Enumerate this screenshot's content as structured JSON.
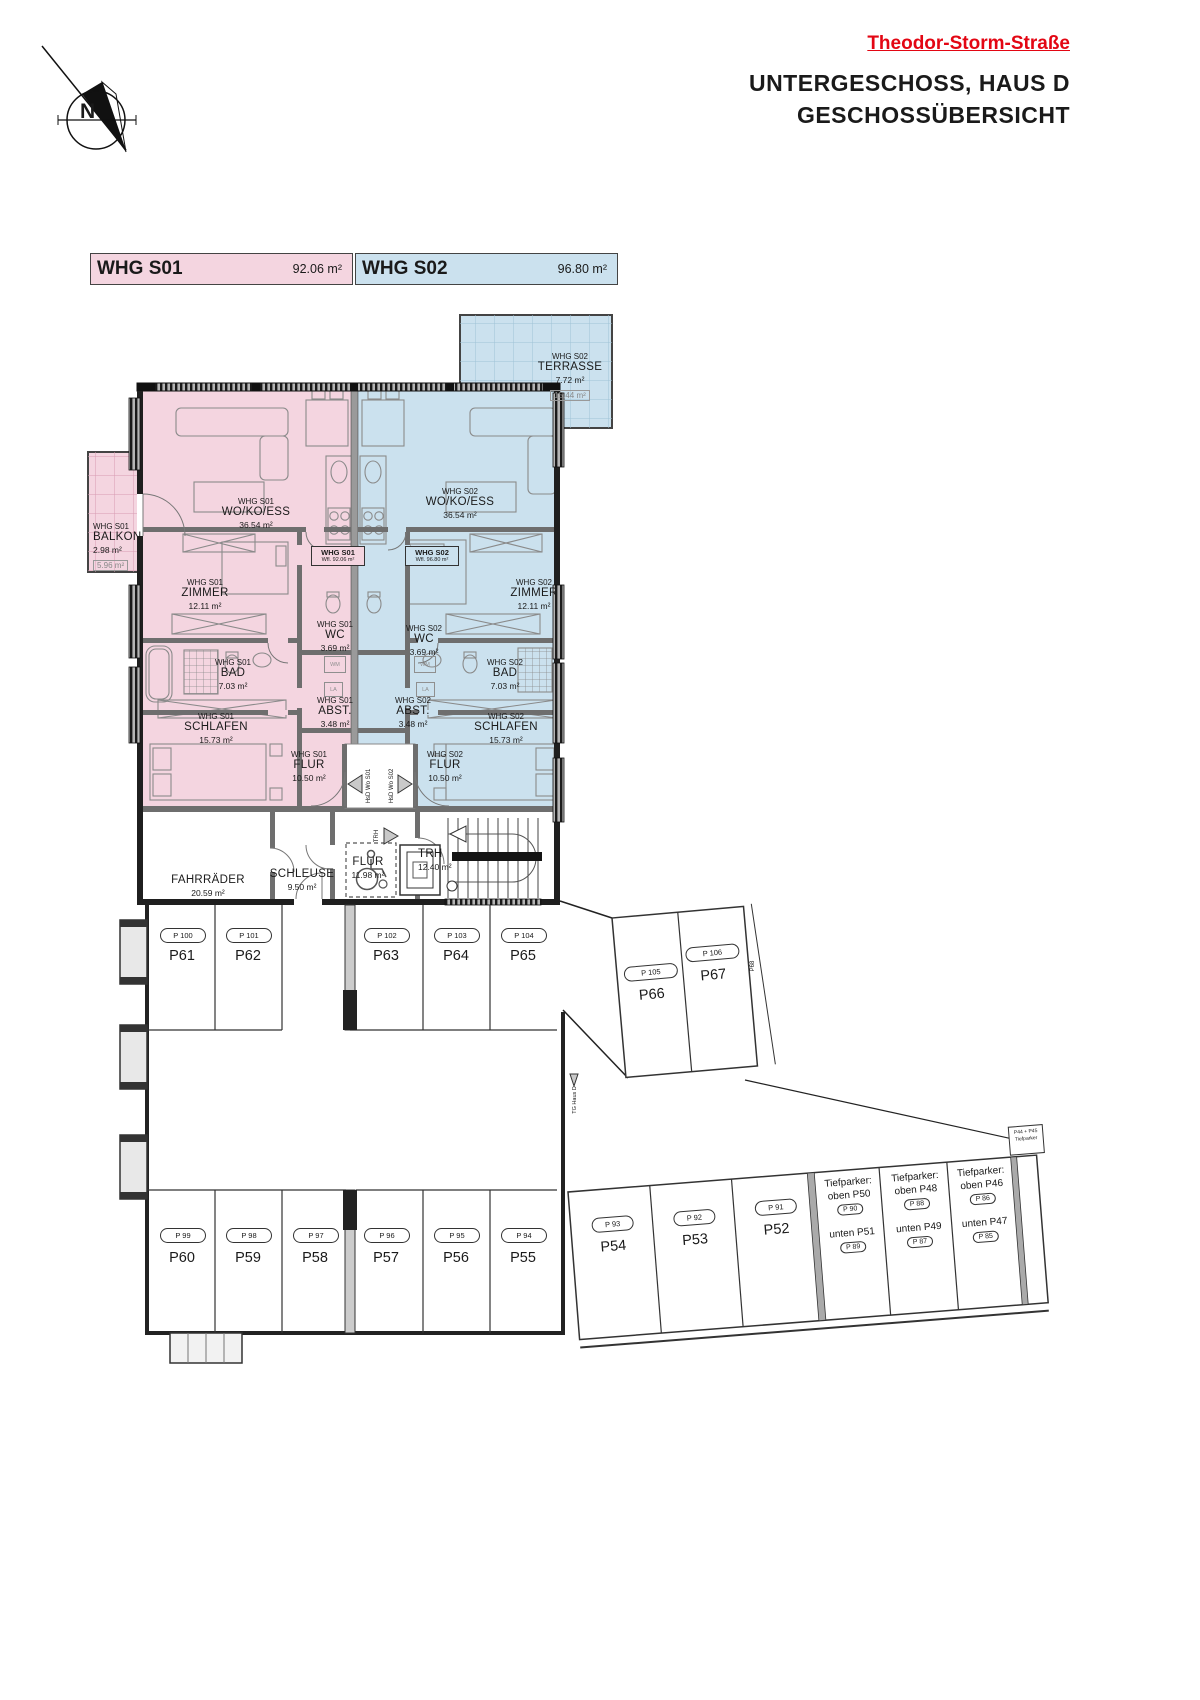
{
  "header": {
    "street": "Theodor-Storm-Straße",
    "line1": "UNTERGESCHOSS, HAUS D",
    "line2": "GESCHOSSÜBERSICHT"
  },
  "compass": {
    "n": "N"
  },
  "colors": {
    "s01": "#f4d5e0",
    "s02": "#cbe1ee",
    "accent_red": "#e30613"
  },
  "legend": {
    "s01": {
      "name": "WHG S01",
      "area": "92.06 m²"
    },
    "s02": {
      "name": "WHG S02",
      "area": "96.80 m²"
    }
  },
  "wfl": {
    "s01": {
      "line1": "WHG S01",
      "line2": "Wfl. 92.06 m²"
    },
    "s02": {
      "line1": "WHG S02",
      "line2": "Wfl. 96.80 m²"
    }
  },
  "outdoor": {
    "terrasse": {
      "whg": "WHG S02",
      "name": "TERRASSE",
      "area": "7.72 m²",
      "half": "15.44 m²"
    },
    "balkon": {
      "whg": "WHG S01",
      "name": "BALKON",
      "area": "2.98 m²",
      "half": "5.96 m²"
    }
  },
  "apartments": {
    "s01": {
      "rooms": {
        "wo": {
          "whg": "WHG S01",
          "name": "WO/KO/ESS",
          "area": "36.54 m²"
        },
        "zimmer": {
          "whg": "WHG S01",
          "name": "ZIMMER",
          "area": "12.11 m²"
        },
        "wc": {
          "whg": "WHG S01",
          "name": "WC",
          "area": "3.69 m²"
        },
        "bad": {
          "whg": "WHG S01",
          "name": "BAD",
          "area": "7.03 m²"
        },
        "abst": {
          "whg": "WHG S01",
          "name": "ABST.",
          "area": "3.48 m²"
        },
        "schlafen": {
          "whg": "WHG S01",
          "name": "SCHLAFEN",
          "area": "15.73 m²"
        },
        "flur": {
          "whg": "WHG S01",
          "name": "FLUR",
          "area": "10.50 m²"
        }
      }
    },
    "s02": {
      "rooms": {
        "wo": {
          "whg": "WHG S02",
          "name": "WO/KO/ESS",
          "area": "36.54 m²"
        },
        "zimmer": {
          "whg": "WHG S02",
          "name": "ZIMMER",
          "area": "12.11 m²"
        },
        "wc": {
          "whg": "WHG S02",
          "name": "WC",
          "area": "3.69 m²"
        },
        "bad": {
          "whg": "WHG S02",
          "name": "BAD",
          "area": "7.03 m²"
        },
        "abst": {
          "whg": "WHG S02",
          "name": "ABST.",
          "area": "3.48 m²"
        },
        "schlafen": {
          "whg": "WHG S02",
          "name": "SCHLAFEN",
          "area": "15.73 m²"
        },
        "flur": {
          "whg": "WHG S02",
          "name": "FLUR",
          "area": "10.50 m²"
        }
      }
    }
  },
  "common": {
    "fahrraeder": {
      "name": "FAHRRÄDER",
      "area": "20.59 m²"
    },
    "schleuse": {
      "name": "SCHLEUSE",
      "area": "9.50 m²"
    },
    "flur": {
      "name": "FLUR",
      "area": "11.98 m²"
    },
    "trh": {
      "name": "TRH",
      "area": "12.40 m²"
    }
  },
  "markers": {
    "hsd_s01": "HsD Wo S01",
    "hsd_s02": "HsD Wo S02",
    "trh": "TRH",
    "tg": "TG Haus D",
    "p68": "P68"
  },
  "boxes": {
    "wm": "WM",
    "la": "LA"
  },
  "parking": {
    "top_row": [
      {
        "code": "P 100",
        "id": "P61"
      },
      {
        "code": "P 101",
        "id": "P62"
      },
      {
        "code": "P 102",
        "id": "P63"
      },
      {
        "code": "P 103",
        "id": "P64"
      },
      {
        "code": "P 104",
        "id": "P65"
      }
    ],
    "bottom_row": [
      {
        "code": "P 99",
        "id": "P60"
      },
      {
        "code": "P 98",
        "id": "P59"
      },
      {
        "code": "P 97",
        "id": "P58"
      },
      {
        "code": "P 96",
        "id": "P57"
      },
      {
        "code": "P 95",
        "id": "P56"
      },
      {
        "code": "P 94",
        "id": "P55"
      }
    ],
    "ne_row": [
      {
        "code": "P 105",
        "id": "P66"
      },
      {
        "code": "P 106",
        "id": "P67"
      }
    ],
    "se_row": [
      {
        "code": "P 93",
        "id": "P54"
      },
      {
        "code": "P 92",
        "id": "P53"
      },
      {
        "code": "P 91",
        "id": "P52"
      }
    ],
    "tief": [
      {
        "title": "Tiefparker:",
        "oben": "oben P50",
        "oben_code": "P 90",
        "unten": "unten P51",
        "unten_code": "P 89"
      },
      {
        "title": "Tiefparker:",
        "oben": "oben P48",
        "oben_code": "P 88",
        "unten": "unten P49",
        "unten_code": "P 87"
      },
      {
        "title": "Tiefparker:",
        "oben": "oben P46",
        "oben_code": "P 86",
        "unten": "unten P47",
        "unten_code": "P 85"
      }
    ],
    "note": {
      "line1": "P44 + P45",
      "line2": "Tiefparker"
    }
  }
}
